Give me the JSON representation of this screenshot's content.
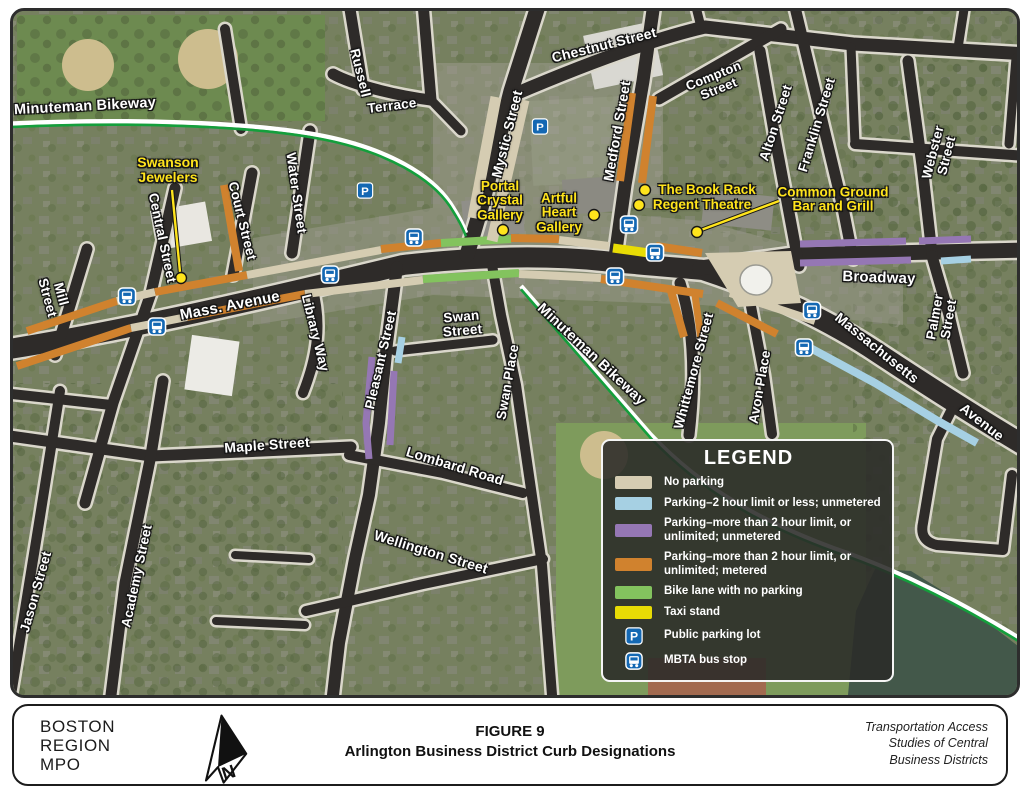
{
  "map": {
    "colors": {
      "beige": "#d5ccb2",
      "blue": "#a6d0e3",
      "purple": "#9577b4",
      "orange": "#d0822e",
      "green": "#83c35e",
      "yellow": "#e8dc05",
      "street": "#2e2b29",
      "casing": "#dad7cb",
      "bikegreen": "#149f3c",
      "water": "#43584a",
      "iconblue": "#1468b3",
      "poiyellow": "#ffe41c"
    },
    "street_labels": [
      {
        "t": "Minuteman Bikeway",
        "x": 82,
        "y": 104,
        "r": -3,
        "s": 14.5
      },
      {
        "t": "Russell",
        "x": 357,
        "y": 70,
        "r": 76,
        "s": 13.5
      },
      {
        "t": "Terrace",
        "x": 389,
        "y": 103,
        "r": -7,
        "s": 13.5
      },
      {
        "t": "Chestnut Street",
        "x": 601,
        "y": 42,
        "r": -14,
        "s": 14
      },
      {
        "t": "Mystic Street",
        "x": 504,
        "y": 131,
        "r": -76,
        "s": 14
      },
      {
        "t": "Medford Street",
        "x": 614,
        "y": 128,
        "r": -80,
        "s": 14
      },
      {
        "t": "Compton\nStreet",
        "x": 713,
        "y": 79,
        "r": -22,
        "s": 13
      },
      {
        "t": "Alton Street",
        "x": 773,
        "y": 120,
        "r": -72,
        "s": 13.5
      },
      {
        "t": "Franklin Street",
        "x": 814,
        "y": 122,
        "r": -73,
        "s": 13.5
      },
      {
        "t": "Webster Street",
        "x": 937,
        "y": 151,
        "r": -76,
        "s": 13.5
      },
      {
        "t": "Water Street",
        "x": 293,
        "y": 190,
        "r": 82,
        "s": 13.5
      },
      {
        "t": "Court Street",
        "x": 239,
        "y": 218,
        "r": 76,
        "s": 13.5
      },
      {
        "t": "Central Street",
        "x": 159,
        "y": 235,
        "r": 78,
        "s": 13.5
      },
      {
        "t": "Mill\nStreet",
        "x": 51,
        "y": 293,
        "r": 75,
        "s": 13.5
      },
      {
        "t": "Mass. Avenue",
        "x": 227,
        "y": 303,
        "r": -11,
        "s": 15
      },
      {
        "t": "Library Way",
        "x": 312,
        "y": 330,
        "r": 76,
        "s": 13.5
      },
      {
        "t": "Pleasant Street",
        "x": 378,
        "y": 357,
        "r": -77,
        "s": 13.5
      },
      {
        "t": "Swan\nStreet",
        "x": 459,
        "y": 321,
        "r": -5,
        "s": 13.5
      },
      {
        "t": "Swan Place",
        "x": 505,
        "y": 379,
        "r": -80,
        "s": 13.5
      },
      {
        "t": "Minuteman Bikeway",
        "x": 588,
        "y": 352,
        "r": 43,
        "s": 14.5
      },
      {
        "t": "Whittemore Street",
        "x": 691,
        "y": 368,
        "r": -75,
        "s": 13.5
      },
      {
        "t": "Avon Place",
        "x": 757,
        "y": 384,
        "r": -80,
        "s": 13.5
      },
      {
        "t": "Broadway",
        "x": 876,
        "y": 275,
        "r": 2,
        "s": 15
      },
      {
        "t": "Massachusetts",
        "x": 874,
        "y": 345,
        "r": 39,
        "s": 14
      },
      {
        "t": "Avenue",
        "x": 979,
        "y": 419,
        "r": 38,
        "s": 14
      },
      {
        "t": "Palmer Street",
        "x": 939,
        "y": 315,
        "r": -80,
        "s": 13.5
      },
      {
        "t": "Maple Street",
        "x": 264,
        "y": 442,
        "r": -4,
        "s": 14
      },
      {
        "t": "Lombard Road",
        "x": 452,
        "y": 463,
        "r": 17,
        "s": 14
      },
      {
        "t": "Wellington Street",
        "x": 428,
        "y": 549,
        "r": 17,
        "s": 14
      },
      {
        "t": "Academy Street",
        "x": 134,
        "y": 573,
        "r": -78,
        "s": 13.5
      },
      {
        "t": "Jason Street",
        "x": 33,
        "y": 589,
        "r": -74,
        "s": 13.5
      }
    ],
    "poi_labels": [
      {
        "t": "Swanson\nJewelers",
        "x": 165,
        "y": 167,
        "s": 14
      },
      {
        "t": "Portal\nCrystal\nGallery",
        "x": 497,
        "y": 198,
        "s": 13.5
      },
      {
        "t": "Artful\nHeart\nGallery",
        "x": 556,
        "y": 210,
        "s": 13.5
      },
      {
        "t": "The Book Rack",
        "x": 704,
        "y": 187,
        "s": 13.5
      },
      {
        "t": "Regent Theatre",
        "x": 699,
        "y": 202,
        "s": 13.5
      },
      {
        "t": "Common Ground\nBar and Grill",
        "x": 830,
        "y": 197,
        "s": 13.5
      }
    ],
    "poi_dots": [
      {
        "x": 178,
        "y": 275
      },
      {
        "x": 500,
        "y": 227
      },
      {
        "x": 591,
        "y": 212
      },
      {
        "x": 642,
        "y": 187
      },
      {
        "x": 636,
        "y": 202
      },
      {
        "x": 694,
        "y": 229
      }
    ],
    "poi_leaders": [
      {
        "x1": 169,
        "y1": 187,
        "x2": 177,
        "y2": 269
      },
      {
        "x1": 776,
        "y1": 198,
        "x2": 698,
        "y2": 227
      }
    ],
    "parking_icons": [
      {
        "x": 362,
        "y": 190
      },
      {
        "x": 537,
        "y": 126
      }
    ],
    "bus_icons": [
      {
        "x": 124,
        "y": 296
      },
      {
        "x": 154,
        "y": 326
      },
      {
        "x": 327,
        "y": 274
      },
      {
        "x": 411,
        "y": 237
      },
      {
        "x": 626,
        "y": 224
      },
      {
        "x": 652,
        "y": 252
      },
      {
        "x": 612,
        "y": 276
      },
      {
        "x": 809,
        "y": 310
      },
      {
        "x": 801,
        "y": 347
      }
    ],
    "streets": [
      {
        "d": "M 0,347 C 120,328 260,296 400,262 C 470,254 540,252 600,258 C 650,263 680,265 700,267 C 770,290 830,320 875,350 C 925,383 975,415 1024,444",
        "w": 20
      },
      {
        "d": "M 697,265 L 790,252 L 1024,247",
        "w": 15
      },
      {
        "d": "M 536,0 L 508,88 L 478,205 L 464,252",
        "w": 15
      },
      {
        "d": "M 510,92 C 585,60 650,36 702,24 L 850,41 L 1024,51",
        "w": 13
      },
      {
        "d": "M 651,0 L 640,78 L 622,182 L 612,254",
        "w": 13
      },
      {
        "d": "M 656,96 L 778,26",
        "w": 11
      },
      {
        "d": "M 757,48 L 773,140 L 796,263",
        "w": 11
      },
      {
        "d": "M 791,0 L 813,92 L 840,205 L 850,256",
        "w": 11
      },
      {
        "d": "M 905,58 L 919,162 L 929,251",
        "w": 11
      },
      {
        "d": "M 929,253 L 946,312 L 960,370",
        "w": 11
      },
      {
        "d": "M 852,141 L 1024,153",
        "w": 10
      },
      {
        "d": "M 962,0 L 955,45",
        "w": 9
      },
      {
        "d": "M 1013,55 L 1006,141",
        "w": 9
      },
      {
        "d": "M 848,44 L 852,141",
        "w": 9
      },
      {
        "d": "M 698,24 L 692,0",
        "w": 9
      },
      {
        "d": "M 346,0 L 360,86",
        "w": 11
      },
      {
        "d": "M 330,71 C 350,82 395,93 428,97",
        "w": 11
      },
      {
        "d": "M 420,0 L 428,97",
        "w": 11
      },
      {
        "d": "M 428,97 L 458,128",
        "w": 9
      },
      {
        "d": "M 222,26 L 238,126",
        "w": 10
      },
      {
        "d": "M 307,128 L 289,250",
        "w": 11
      },
      {
        "d": "M 249,170 L 230,272",
        "w": 11
      },
      {
        "d": "M 172,185 L 148,290 L 110,400 L 82,500",
        "w": 11
      },
      {
        "d": "M 84,246 L 52,352",
        "w": 11
      },
      {
        "d": "M 0,390 L 108,402",
        "w": 10
      },
      {
        "d": "M 309,283 C 319,320 315,352 300,390",
        "w": 10
      },
      {
        "d": "M 394,264 L 384,340 L 376,420 L 366,492 L 352,556 L 336,640 L 330,692",
        "w": 12
      },
      {
        "d": "M 392,348 L 490,337",
        "w": 9
      },
      {
        "d": "M 489,262 L 498,312 L 513,382 L 521,438 L 539,562 L 549,692",
        "w": 10
      },
      {
        "d": "M 346,452 L 440,470 L 520,490",
        "w": 10
      },
      {
        "d": "M 303,608 L 420,581 L 540,556",
        "w": 10
      },
      {
        "d": "M 0,432 L 148,453 L 348,444",
        "w": 11
      },
      {
        "d": "M 160,378 L 148,452 L 122,580 L 108,692",
        "w": 11
      },
      {
        "d": "M 57,388 L 36,520 L 12,668 L 8,692",
        "w": 10
      },
      {
        "d": "M 232,552 L 306,556",
        "w": 8
      },
      {
        "d": "M 213,618 L 302,622",
        "w": 8
      },
      {
        "d": "M 677,280 C 690,320 693,372 686,432",
        "w": 11
      },
      {
        "d": "M 747,298 L 761,372 L 769,431",
        "w": 10
      },
      {
        "d": "M 948,408 L 934,436 L 920,520 Q 916,538 934,542 L 1000,547 L 1009,472",
        "w": 10
      }
    ],
    "curbs": [
      {
        "c": "orange",
        "d": "M 24,328 L 114,298"
      },
      {
        "c": "beige",
        "d": "M 114,298 L 152,289"
      },
      {
        "c": "orange",
        "d": "M 152,289 L 244,272"
      },
      {
        "c": "beige",
        "d": "M 244,272 L 378,247"
      },
      {
        "c": "orange",
        "d": "M 378,246 L 438,240"
      },
      {
        "c": "green",
        "d": "M 438,240 L 508,236"
      },
      {
        "c": "orange",
        "d": "M 508,235 L 556,236"
      },
      {
        "c": "beige",
        "d": "M 556,237 L 606,243"
      },
      {
        "c": "yellow",
        "d": "M 610,245 L 646,250",
        "w": 9
      },
      {
        "c": "orange",
        "d": "M 653,243 L 699,250"
      },
      {
        "c": "orange",
        "d": "M 14,363 L 128,325"
      },
      {
        "c": "beige",
        "d": "M 128,325 L 184,314"
      },
      {
        "c": "orange",
        "d": "M 184,314 L 302,291"
      },
      {
        "c": "beige",
        "d": "M 302,291 L 420,277"
      },
      {
        "c": "green",
        "d": "M 420,276 L 516,270"
      },
      {
        "c": "beige",
        "d": "M 516,271 L 598,275"
      },
      {
        "c": "orange",
        "d": "M 598,276 L 700,291"
      },
      {
        "c": "beige",
        "d": "M 702,250 L 788,248 L 798,300 L 735,304 Z",
        "f": true
      },
      {
        "c": "beige",
        "d": "M 727,290 L 812,318"
      },
      {
        "c": "blue",
        "d": "M 800,341 L 872,380 L 935,418 L 974,440"
      },
      {
        "c": "purple",
        "d": "M 797,241 L 903,238",
        "w": 7
      },
      {
        "c": "purple",
        "d": "M 916,238 L 968,236",
        "w": 7
      },
      {
        "c": "purple",
        "d": "M 797,260 L 908,257",
        "w": 7
      },
      {
        "c": "blue",
        "d": "M 938,258 L 968,256",
        "w": 7
      },
      {
        "c": "orange",
        "d": "M 668,288 L 681,334"
      },
      {
        "c": "orange",
        "d": "M 692,292 L 698,336",
        "w": 7
      },
      {
        "c": "orange",
        "d": "M 714,300 L 774,331"
      },
      {
        "c": "orange",
        "d": "M 221,182 L 236,268"
      },
      {
        "c": "orange",
        "d": "M 629,90 L 617,178"
      },
      {
        "c": "orange",
        "d": "M 650,93 L 639,180"
      },
      {
        "c": "beige",
        "d": "M 493,94 L 470,215",
        "w": 11
      },
      {
        "c": "beige",
        "d": "M 521,97 L 489,238",
        "w": 11
      },
      {
        "c": "purple",
        "d": "M 369,354 L 363,420 L 366,456",
        "w": 7
      },
      {
        "c": "purple",
        "d": "M 391,368 L 387,442",
        "w": 7
      },
      {
        "c": "blue",
        "d": "M 399,334 L 395,360",
        "w": 7
      }
    ],
    "bikeway": [
      "M 0,121 C 120,115 250,119 320,133 C 385,146 428,172 447,200 C 456,214 459,220 463,230",
      "M 518,283 L 648,432 C 700,487 760,519 830,545 C 900,569 962,601 1024,640"
    ],
    "legend": {
      "title": "LEGEND",
      "items": [
        {
          "swatch": "beige",
          "label": "No parking"
        },
        {
          "swatch": "blue",
          "label": "Parking–2 hour limit or less; unmetered"
        },
        {
          "swatch": "purple",
          "label": "Parking–more than 2 hour limit, or unlimited; unmetered"
        },
        {
          "swatch": "orange",
          "label": "Parking–more than 2 hour limit, or unlimited; metered"
        },
        {
          "swatch": "green",
          "label": "Bike lane with no parking"
        },
        {
          "swatch": "yellow",
          "label": "Taxi stand"
        },
        {
          "icon": "parking",
          "label": "Public parking lot"
        },
        {
          "icon": "bus",
          "label": "MBTA bus stop"
        }
      ]
    }
  },
  "footer": {
    "org": "BOSTON\nREGION\nMPO",
    "figure_label": "FIGURE 9",
    "figure_title": "Arlington Business District Curb Designations",
    "source": "Transportation Access\nStudies of Central\nBusiness Districts"
  }
}
